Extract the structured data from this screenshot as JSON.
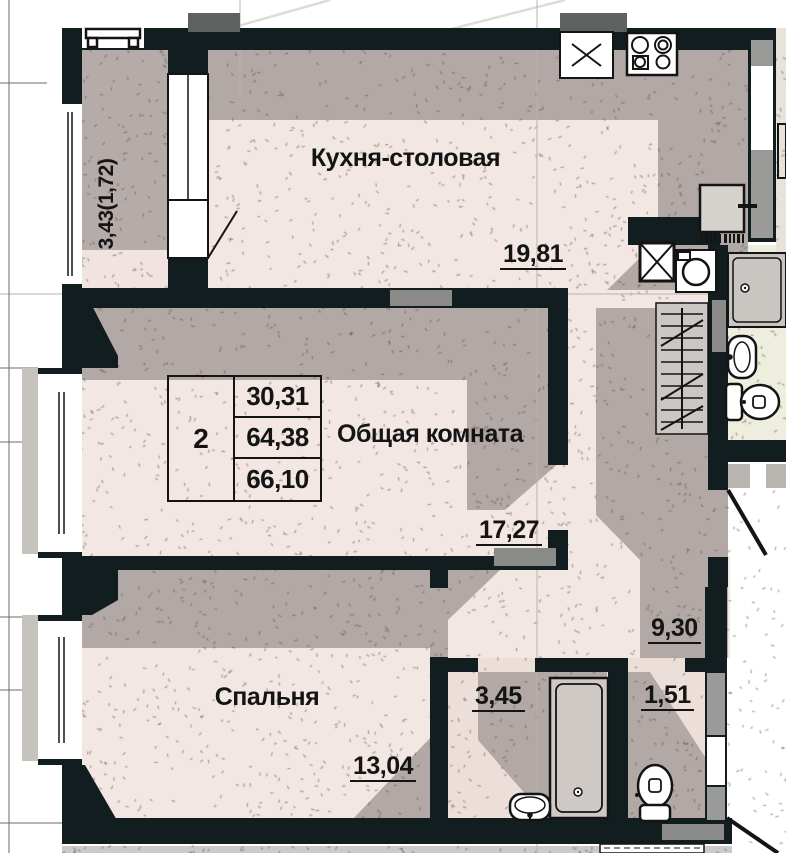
{
  "plan": {
    "type": "apartment-floor-plan",
    "rooms": {
      "kitchen": {
        "label": "Кухня-столовая",
        "area": "19,81"
      },
      "living": {
        "label": "Общая комната",
        "area": "17,27"
      },
      "bedroom": {
        "label": "Спальня",
        "area": "13,04"
      },
      "bathroom": {
        "area": "3,45"
      },
      "toilet": {
        "area": "1,51"
      },
      "hall": {
        "area": "9,30"
      },
      "balcony": {
        "area": "3,43(1,72)"
      }
    },
    "info_table": {
      "rooms_count": "2",
      "living_area": "30,31",
      "apartment_area": "64,38",
      "total_area": "66,10"
    },
    "fixtures": [
      "kitchen-sink-icon",
      "stove-icon",
      "fridge-icon",
      "vent-shaft-icon",
      "washing-machine-icon",
      "wardrobe-icon",
      "bathtub-icon",
      "washbasin-icon",
      "toilet-icon",
      "ac-bracket-icon",
      "neighbor-bathtub-icon",
      "neighbor-washbasin-icon",
      "neighbor-toilet-icon"
    ],
    "colors": {
      "wall": "#111d1f",
      "floor_pink": "#f3e7e3",
      "shadow_grey": "#b2a8a5",
      "balcony_grey": "#b5acaa",
      "neighbor_bath_floor": "#edeedd",
      "neighbor_room_beige": "#e7e3d9",
      "wall_insert_grey": "#8a8a88",
      "vent_block_grey": "#5d6261"
    }
  }
}
